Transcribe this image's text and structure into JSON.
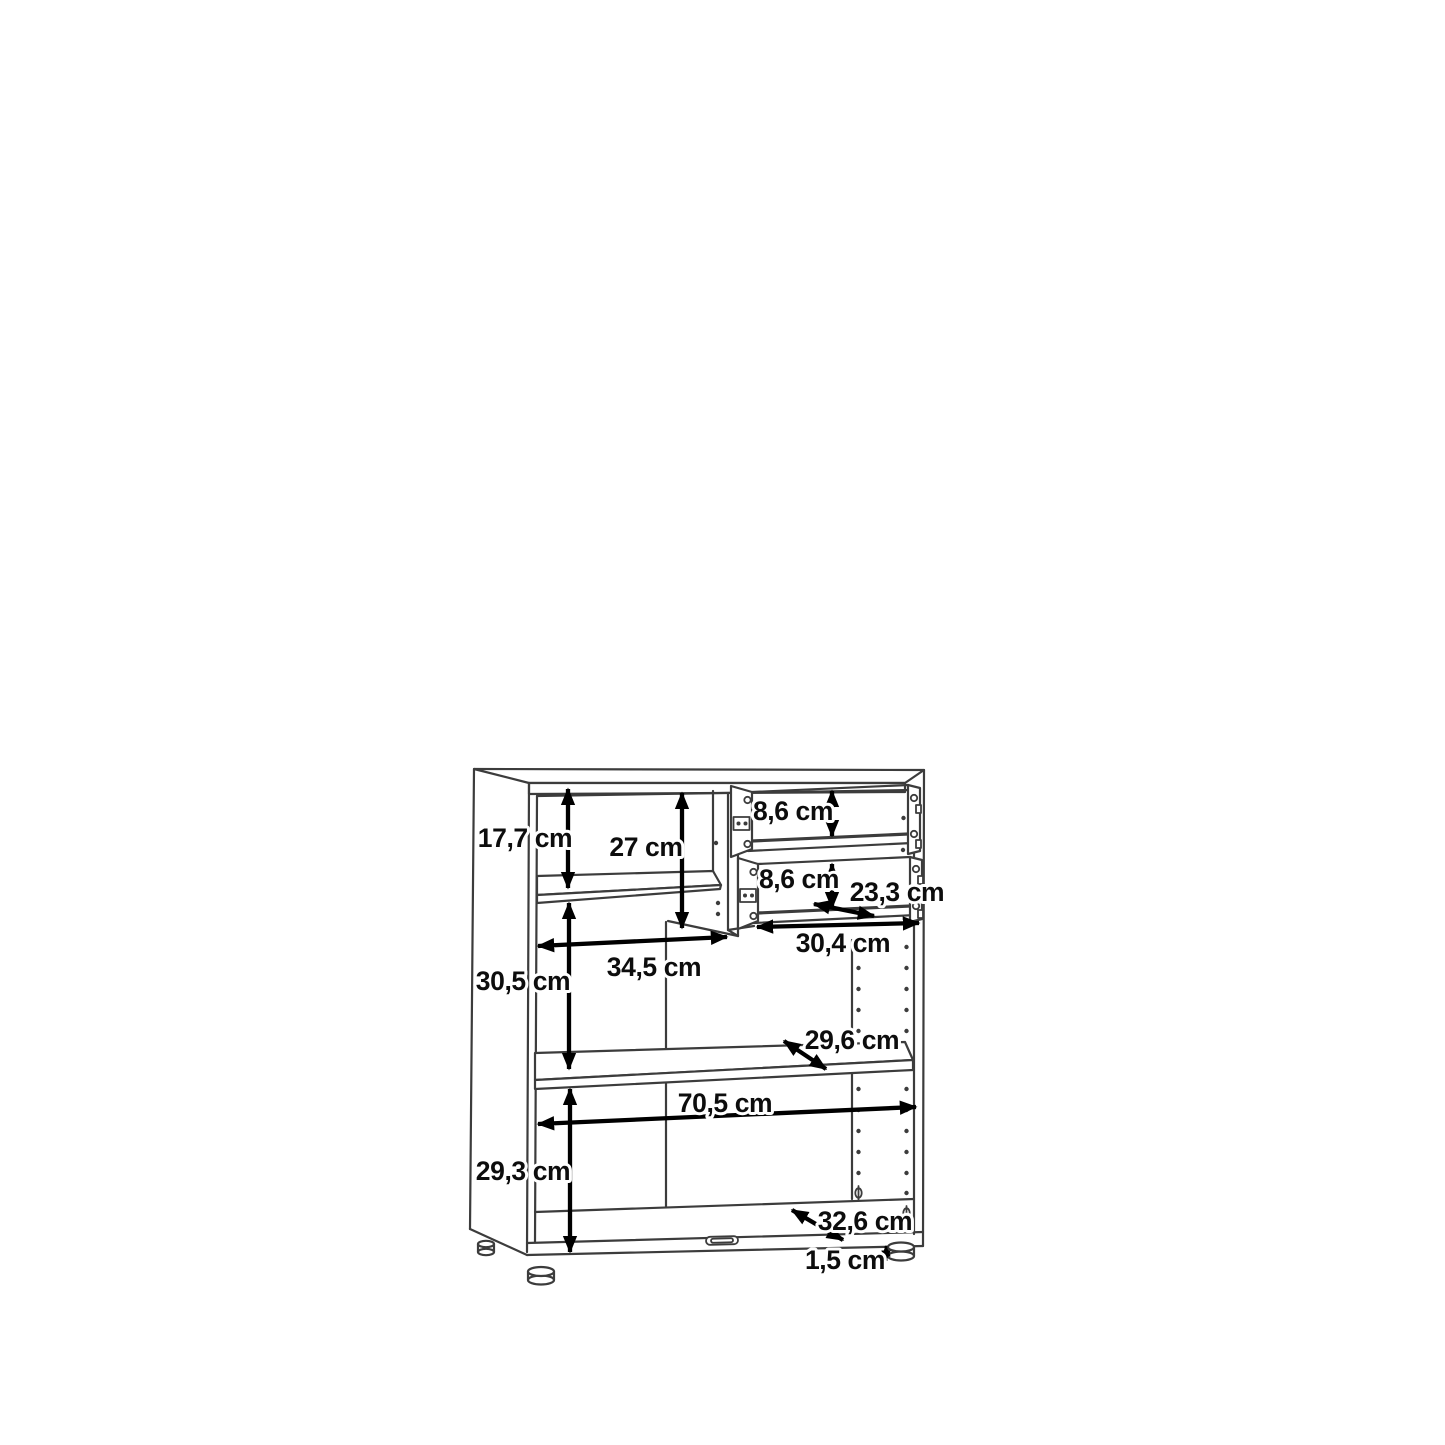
{
  "diagram": {
    "type": "furniture-dimension-drawing",
    "subject": "cabinet with shelves and two open drawers",
    "unit": "cm",
    "colors": {
      "background": "#ffffff",
      "drawing_lines": "#3c3c3c",
      "dimension_arrows": "#000000",
      "dimension_text": "#0d0d0d"
    },
    "dimensions": [
      {
        "name": "top-left-compartment-height",
        "label": "17,7 cm"
      },
      {
        "name": "partition-height",
        "label": "27 cm"
      },
      {
        "name": "upper-drawer-inner-height",
        "label": "8,6 cm"
      },
      {
        "name": "lower-drawer-inner-height",
        "label": "8,6 cm"
      },
      {
        "name": "drawer-depth",
        "label": "23,3 cm"
      },
      {
        "name": "drawer-width",
        "label": "30,4 cm"
      },
      {
        "name": "left-shelf-width",
        "label": "34,5 cm"
      },
      {
        "name": "middle-compartment-height",
        "label": "30,5 cm"
      },
      {
        "name": "shelf-depth",
        "label": "29,6 cm"
      },
      {
        "name": "interior-width",
        "label": "70,5 cm"
      },
      {
        "name": "bottom-compartment-height",
        "label": "29,3 cm"
      },
      {
        "name": "base-panel-depth",
        "label": "32,6 cm"
      },
      {
        "name": "foot-height",
        "label": "1,5 cm"
      }
    ]
  }
}
